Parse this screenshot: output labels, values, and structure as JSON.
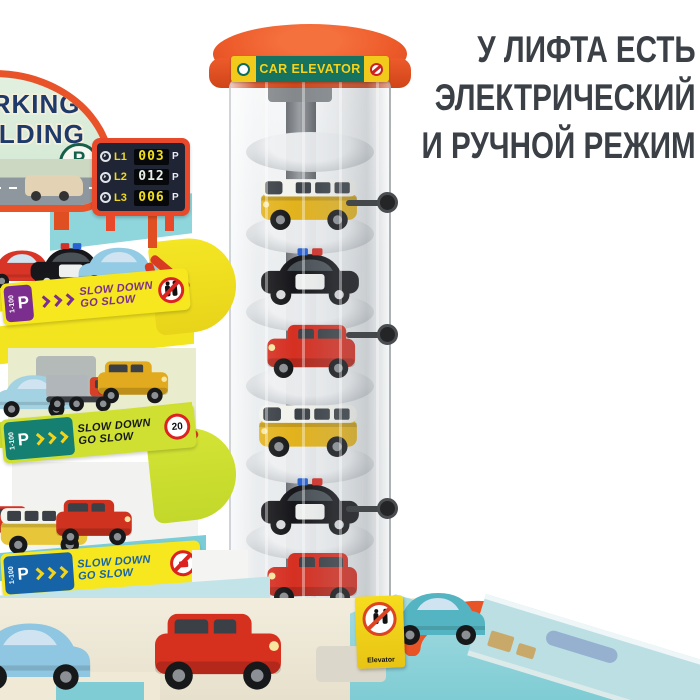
{
  "headline": {
    "lines": [
      "У ЛИФТА ЕСТЬ",
      "ЭЛЕКТРИЧЕСКИЙ",
      "И РУЧНОЙ РЕЖИМ"
    ],
    "color": "#3b4046"
  },
  "elevator": {
    "sign_label": "CAR ELEVATOR",
    "sign_bg": "#15735f",
    "sign_text_color": "#f6d41c",
    "cap_color": "#ee5b2b",
    "left_icon": "elevator-sign-icon",
    "right_icon": "no-passengers-icon",
    "base_sign_label": "Elevator",
    "base_sign_icon": "no-passengers-icon"
  },
  "billboard": {
    "word1": "PARKING",
    "word2": "BUILDING",
    "p_symbol": "P"
  },
  "level_display": {
    "p_symbol": "P",
    "rows": [
      {
        "level": "L1",
        "value": "003",
        "value_color": "#f2df1e"
      },
      {
        "level": "L2",
        "value": "012",
        "value_color": "#e8efe6"
      },
      {
        "level": "L3",
        "value": "006",
        "value_color": "#f2df1e"
      }
    ]
  },
  "banners": [
    {
      "zone": "1-100",
      "p_symbol": "P",
      "line1": "SLOW DOWN",
      "line2": "GO SLOW",
      "icon": "no-pedestrians-icon",
      "bg": "#f6e71f",
      "accent": "#7b2e8e"
    },
    {
      "zone": "1-100",
      "p_symbol": "P",
      "line1": "SLOW DOWN",
      "line2": "GO SLOW",
      "icon": "speed-limit-20-icon",
      "speed": "20",
      "bg": "#cfe033",
      "accent": "#157f72"
    },
    {
      "zone": "1-100",
      "p_symbol": "P",
      "line1": "SLOW DOWN",
      "line2": "GO SLOW",
      "icon": "no-horn-icon",
      "bg": "#f6e71f",
      "accent": "#1663a8"
    }
  ],
  "cars": [
    {
      "name": "elevator-car-van-1",
      "type": "van",
      "color": "#e3b31d",
      "x": 258,
      "y": 168,
      "w": 102,
      "z": 3,
      "flip": true
    },
    {
      "name": "elevator-car-police-1",
      "type": "police",
      "color": "#17171b",
      "x": 258,
      "y": 242,
      "w": 104,
      "z": 3,
      "flip": true
    },
    {
      "name": "elevator-car-red-1",
      "type": "boxy",
      "color": "#d63022",
      "x": 262,
      "y": 318,
      "w": 98,
      "z": 3,
      "flip": true
    },
    {
      "name": "elevator-car-van-2",
      "type": "van",
      "color": "#e3b31d",
      "x": 256,
      "y": 394,
      "w": 104,
      "z": 3,
      "flip": true
    },
    {
      "name": "elevator-car-police-2",
      "type": "police",
      "color": "#17171b",
      "x": 258,
      "y": 472,
      "w": 104,
      "z": 3,
      "flip": true
    },
    {
      "name": "elevator-car-red-2",
      "type": "boxy",
      "color": "#d63022",
      "x": 262,
      "y": 546,
      "w": 100,
      "z": 3,
      "flip": true
    },
    {
      "name": "floor1-car-red",
      "type": "round",
      "color": "#d93526",
      "x": -14,
      "y": 244,
      "w": 72,
      "z": 6
    },
    {
      "name": "floor1-car-police",
      "type": "police",
      "color": "#17171b",
      "x": 28,
      "y": 238,
      "w": 86,
      "z": 6
    },
    {
      "name": "floor1-car-blue",
      "type": "round",
      "color": "#93cbe4",
      "x": 76,
      "y": 240,
      "w": 86,
      "z": 6
    },
    {
      "name": "floor2-car-blue",
      "type": "round",
      "color": "#a3d2e2",
      "x": -6,
      "y": 368,
      "w": 80,
      "z": 6
    },
    {
      "name": "floor2-car-red-tractor",
      "type": "truck",
      "color": "#d64028",
      "color2": "#b0b6ba",
      "x": 44,
      "y": 366,
      "w": 74,
      "z": 6
    },
    {
      "name": "floor2-car-yellow-truck",
      "type": "boxy",
      "color": "#e2aa1e",
      "x": 94,
      "y": 356,
      "w": 78,
      "z": 6
    },
    {
      "name": "floor3-car-red-small",
      "type": "boxy",
      "color": "#d63022",
      "x": -20,
      "y": 502,
      "w": 62,
      "z": 6
    },
    {
      "name": "floor3-car-van",
      "type": "van",
      "color": "#e8c63a",
      "x": -2,
      "y": 498,
      "w": 92,
      "z": 6
    },
    {
      "name": "floor3-car-red-suv",
      "type": "boxy",
      "color": "#cf3320",
      "x": 52,
      "y": 494,
      "w": 84,
      "z": 6
    },
    {
      "name": "base-car-blue",
      "type": "round",
      "color": "#8fc6e2",
      "x": -34,
      "y": 612,
      "w": 128,
      "z": 9
    },
    {
      "name": "base-car-red-suv",
      "type": "boxy",
      "color": "#d6301f",
      "x": 148,
      "y": 604,
      "w": 140,
      "z": 9
    },
    {
      "name": "deck-car-teal",
      "type": "round",
      "color": "#55b4c2",
      "x": 388,
      "y": 584,
      "w": 100,
      "z": 9,
      "flip": true
    }
  ],
  "colors": {
    "cap_orange": "#ee5b2b",
    "sign_green": "#15735f",
    "led_frame": "#e8492b",
    "led_bg": "#1f2535",
    "deck_teal": "#7fccd4",
    "base_cream": "#ebe5d2",
    "floor_yellow": "#f2e41f",
    "floor_lime": "#cfe033",
    "floor_teal": "#79ccd8"
  }
}
